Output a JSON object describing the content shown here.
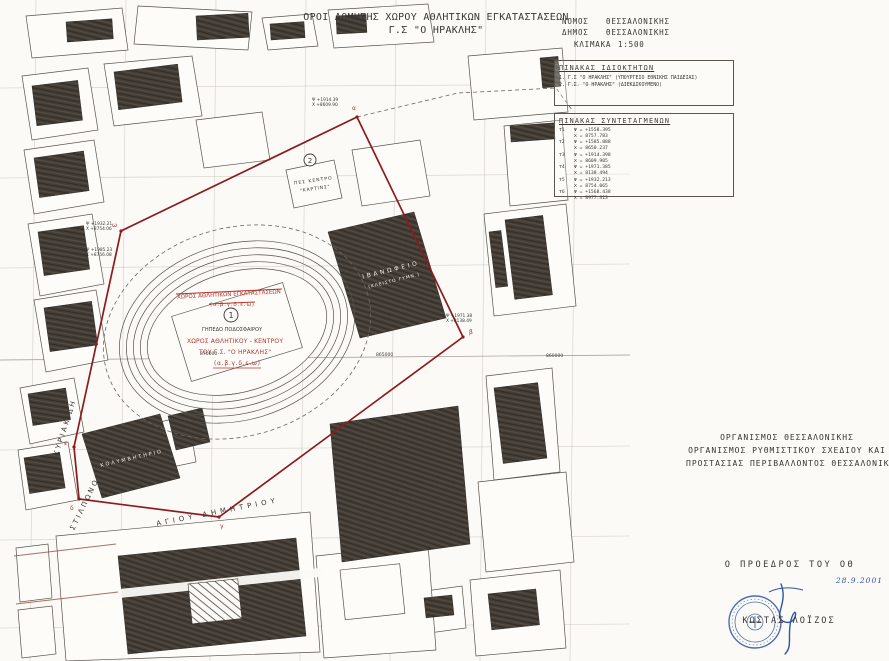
{
  "title": {
    "line1": "ΟΡΟΙ ΔΟΜΗΣΗΣ ΧΩΡΟΥ ΑΘΛΗΤΙΚΩΝ ΕΓΚΑΤΑΣΤΑΣΕΩΝ",
    "line2": "Γ.Σ \"Ο ΗΡΑΚΛΗΣ\""
  },
  "region_header": {
    "rows": [
      {
        "label": "ΝΟΜΟΣ",
        "value": "ΘΕΣΣΑΛΟΝΙΚΗΣ"
      },
      {
        "label": "ΔΗΜΟΣ",
        "value": "ΘΕΣΣΑΛΟΝΙΚΗΣ"
      }
    ],
    "scale_label": "ΚΛΙΜΑΚΑ",
    "scale_value": "1:500"
  },
  "owners_table": {
    "title": "ΠΙΝΑΚΑΣ ΙΔΙΟΚΤΗΤΩΝ",
    "rows": [
      "1. Γ.Σ \"Ο ΗΡΑΚΛΗΣ\" (ΥΠΟΥΡΓΕΙΟ ΕΘΝΙΚΗΣ ΠΑΙΔΕΙΑΣ)",
      "2. Γ.Σ. \"Ο ΗΡΑΚΛΗΣ\" (ΔΙΕΚΔΙΚΟΥΜΕΝΟ)"
    ]
  },
  "coords_table": {
    "title": "ΠΙΝΑΚΑΣ ΣΥΝΤΕΤΑΓΜΕΝΩΝ",
    "points": [
      {
        "id": "Τ1",
        "psi": "Ψ = +1558.395",
        "chi": "Χ = 8757.783"
      },
      {
        "id": "Τ2",
        "psi": "Ψ = +1585.888",
        "chi": "Χ = 8650.237"
      },
      {
        "id": "Τ3",
        "psi": "Ψ = +1914.398",
        "chi": "Χ = 8609.905"
      },
      {
        "id": "Τ4",
        "psi": "Ψ = +1971.385",
        "chi": "Χ = 8138.494"
      },
      {
        "id": "Τ5",
        "psi": "Ψ = +1932.213",
        "chi": "Χ = 8754.065"
      },
      {
        "id": "Τ6",
        "psi": "Ψ = +1568.438",
        "chi": "Χ = 8977.313"
      }
    ]
  },
  "map": {
    "streets": {
      "kyriakidi": "ΚΥΡΙΑΚΙΔΗ",
      "stilponos": "ΣΤΙΛΠΩΝΟΣ",
      "agiou_dimitriou": "ΑΓΙΟΥ  ΔΗΜΗΤΡΙΟΥ"
    },
    "markers": {
      "m1": "1",
      "m2": "2"
    },
    "zone_struck": {
      "line1": "ΧΩΡΟΣ ΑΘΛΗΤΙΚΩΝ ΕΓΚΑΤΑΣΤΑΣΕΩΝ",
      "line2": "(α.β.γ.δ.ε.ω)"
    },
    "zone_red": {
      "line1": "ΧΩΡΟΣ ΑΘΛΗΤΙΚΟΥ - ΚΕΝΤΡΟΥ",
      "line2": "ΤΟΥ Γ.Σ. \"Ο ΗΡΑΚΛΗΣ\"",
      "line3": "(α.β.γ.δ.ε.ω)"
    },
    "buildings": {
      "field": "ΓΗΠΕΔΟ ΠΟΔΟΣΦΑΙΡΟΥ",
      "arena_l1": "ΙΒΑΝΩΦΕΙΟ",
      "arena_l2": "(ΚΛΕΙΣΤΟ ΓΥΜΝ.)",
      "pool": "ΚΟΛΥΜΒΗΤΗΡΙΟ",
      "center_l1": "ΠΕΣ ΚΕΝΤΡΟ",
      "center_l2": "\"ΚΑΡΤΙΝΣ\""
    },
    "grid_labels": [
      "870000",
      "865000",
      "860000"
    ],
    "vertex_letters": [
      "α",
      "β",
      "γ",
      "δ",
      "ε",
      "ω"
    ],
    "point_labels": [
      {
        "l1": "Ψ +1914.39",
        "l2": "Χ +8609.90"
      },
      {
        "l1": "Ψ +1932.21",
        "l2": "Χ +8754.06"
      },
      {
        "l1": "Ψ +1985.23",
        "l2": "Χ +8756.08"
      },
      {
        "l1": "Ψ +1971.38",
        "l2": "Χ +8138.49"
      }
    ]
  },
  "org": {
    "line1": "ΟΡΓΑΝΙΣΜΟΣ ΘΕΣΣΑΛΟΝΙΚΗΣ",
    "line2": "ΟΡΓΑΝΙΣΜΟΣ ΡΥΘΜΙΣΤΙΚΟΥ ΣΧΕΔΙΟΥ ΚΑΙ",
    "line3": "ΠΡΟΣΤΑΣΙΑΣ ΠΕΡΙΒΑΛΛΟΝΤΟΣ ΘΕΣΣΑΛΟΝΙΚΗΣ"
  },
  "approval": {
    "title": "Ο ΠΡΟΕΔΡΟΣ ΤΟΥ ΟΘ",
    "date": "28.9.2001",
    "name": "ΚΩΣΤΑΣ ΛΟΪΖΟΣ"
  },
  "colors": {
    "boundary_red": "#8c1b1e",
    "annotation_red": "#b5342c",
    "stamp_blue": "#2f55a4",
    "ink": "#3a3733"
  }
}
